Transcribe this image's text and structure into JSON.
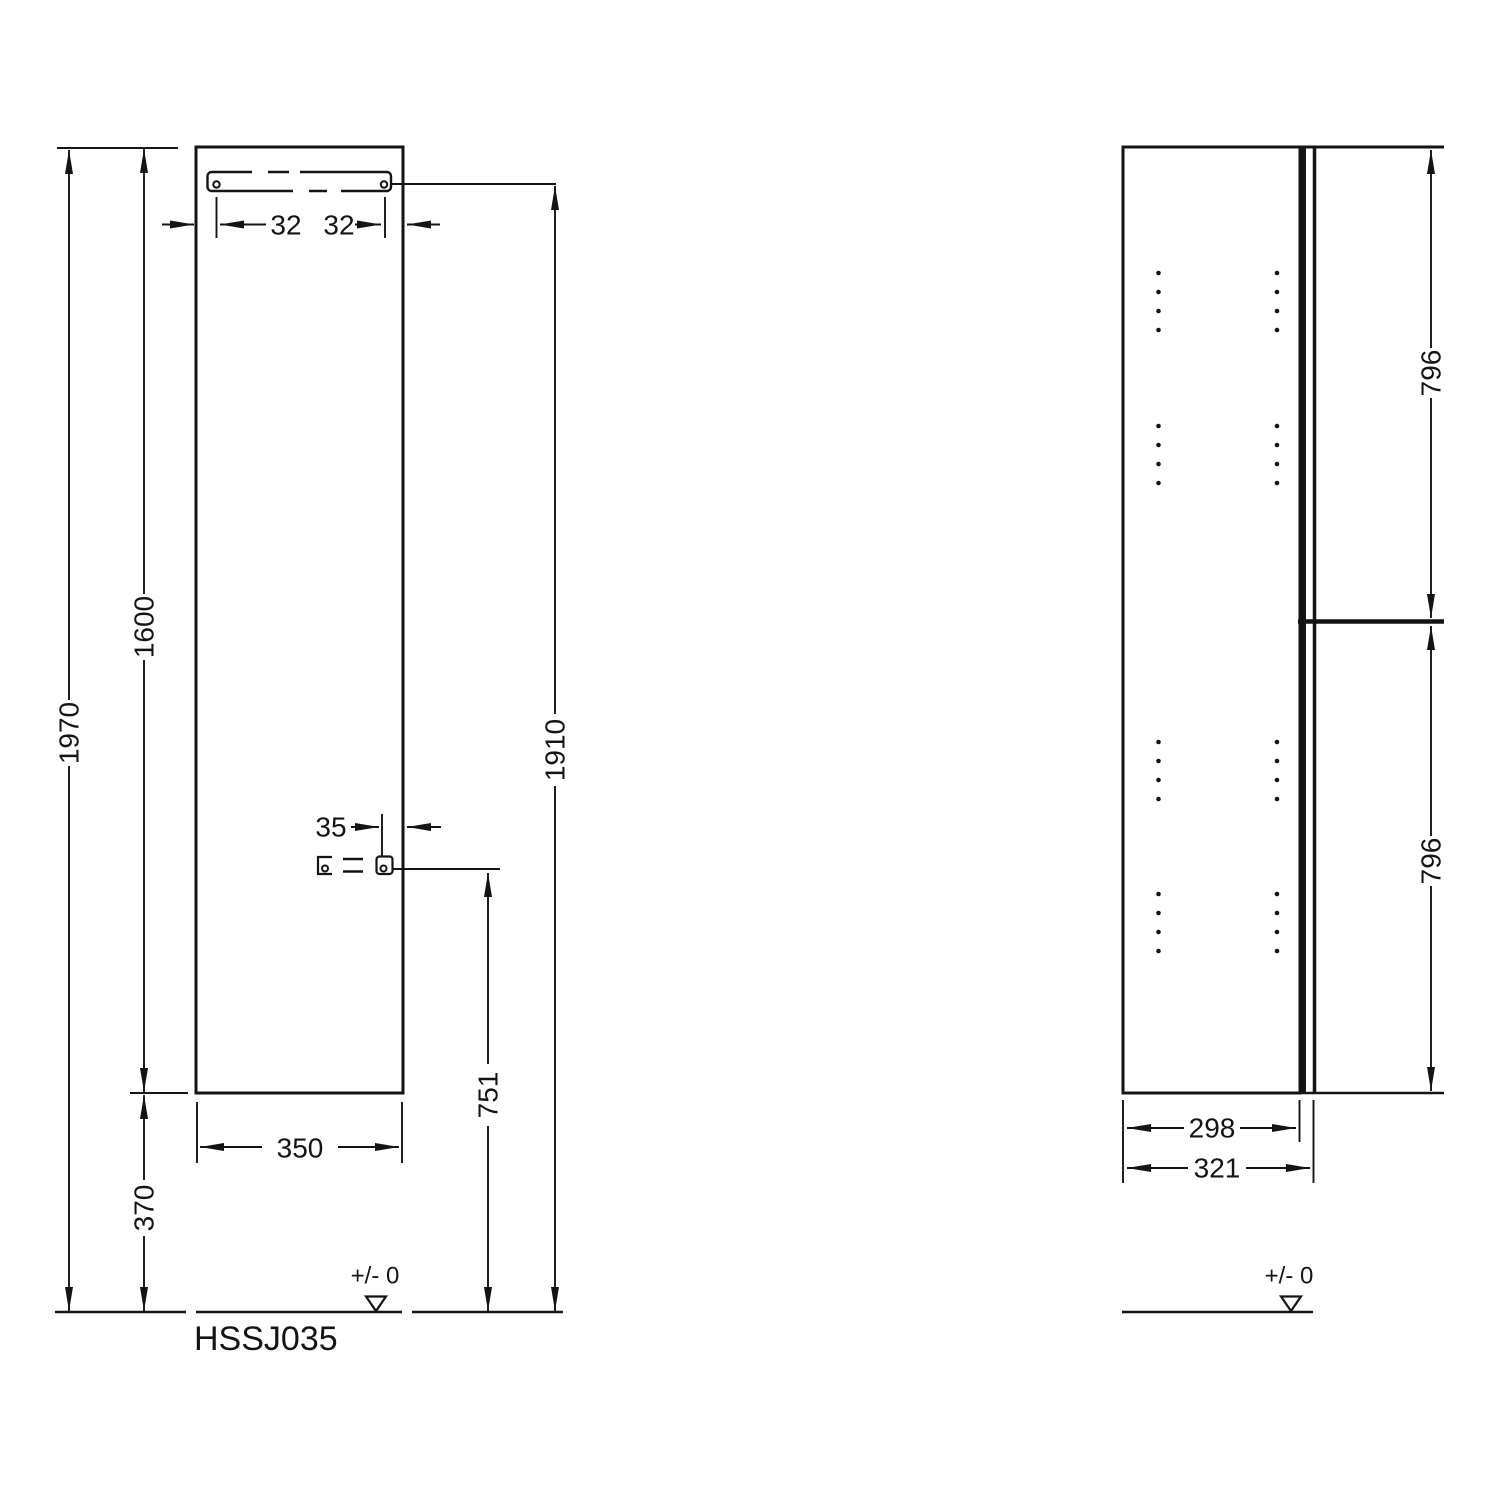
{
  "code": "HSSJ035",
  "front_view": {
    "overall_height": "1970",
    "panel_height": "1600",
    "bottom_clearance": "370",
    "panel_width": "350",
    "rail_hole_inset_left": "32",
    "rail_hole_inset_right": "32",
    "hinge_hole_inset": "35",
    "hinge_hole_height": "751",
    "rail_hole_height": "1910",
    "datum_label": "+/- 0"
  },
  "side_view": {
    "upper_door_height": "796",
    "lower_door_height": "796",
    "body_depth": "298",
    "total_depth": "321",
    "datum_label": "+/- 0"
  },
  "colors": {
    "ink": "#141414",
    "background": "#ffffff"
  }
}
